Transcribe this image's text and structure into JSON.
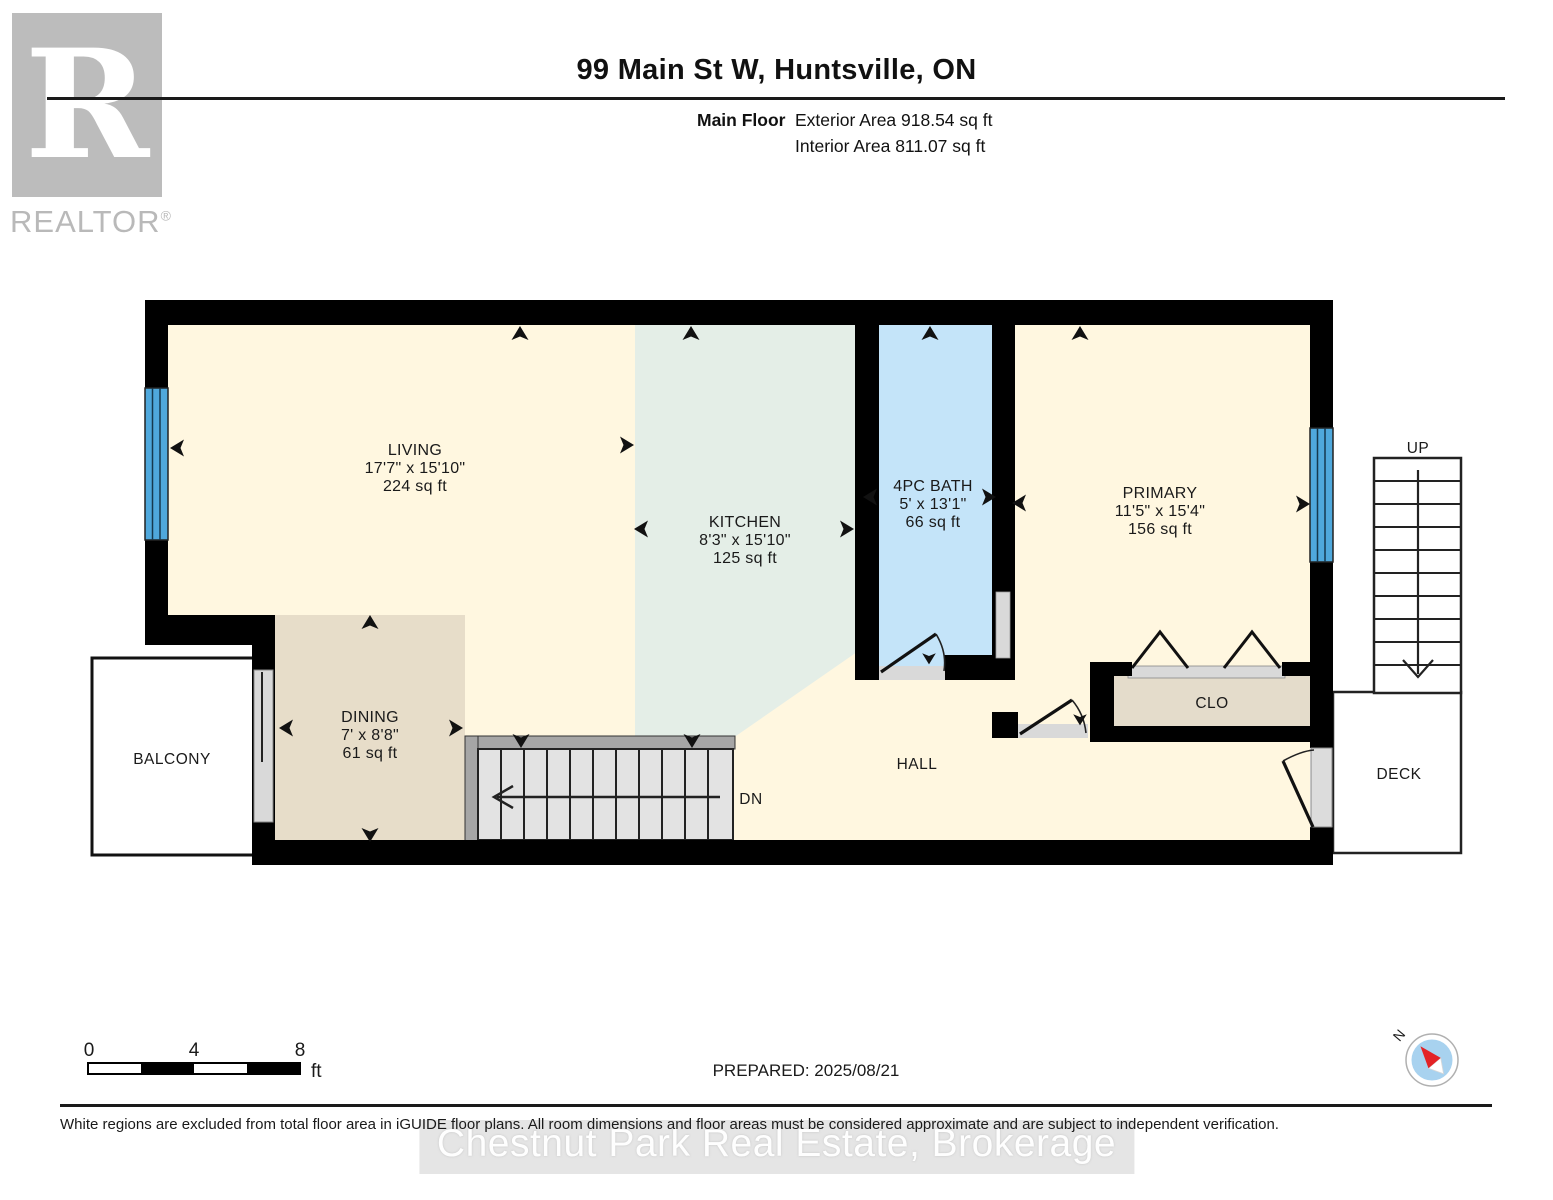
{
  "header": {
    "title": "99 Main St W, Huntsville, ON",
    "floor_label": "Main Floor",
    "exterior_area": "Exterior Area 918.54 sq ft",
    "interior_area": "Interior Area 811.07 sq ft",
    "brand_letter": "R",
    "brand_name": "REALTOR",
    "brand_reg": "®"
  },
  "rooms": {
    "living": {
      "name": "LIVING",
      "dims": "17'7\" x 15'10\"",
      "area": "224 sq ft"
    },
    "kitchen": {
      "name": "KITCHEN",
      "dims": "8'3\" x 15'10\"",
      "area": "125 sq ft"
    },
    "bath": {
      "name": "4PC BATH",
      "dims": "5' x 13'1\"",
      "area": "66 sq ft"
    },
    "primary": {
      "name": "PRIMARY",
      "dims": "11'5\" x 15'4\"",
      "area": "156 sq ft"
    },
    "dining": {
      "name": "DINING",
      "dims": "7' x 8'8\"",
      "area": "61 sq ft"
    }
  },
  "areas": {
    "balcony": "BALCONY",
    "hall": "HALL",
    "closet": "CLO",
    "deck": "DECK",
    "stairs_down": "DN",
    "stairs_up": "UP"
  },
  "scalebar": {
    "ticks": [
      "0",
      "4",
      "8"
    ],
    "unit": "ft"
  },
  "compass": {
    "north": "N"
  },
  "footer": {
    "prepared": "PREPARED: 2025/08/21",
    "disclaimer": "White regions are excluded from total floor area in iGUIDE floor plans. All room dimensions and floor areas must be considered approximate and are subject to independent verification.",
    "watermark": "Chestnut Park Real Estate, Brokerage"
  },
  "colors": {
    "wall": "#000000",
    "room_cream": "#FFF7E0",
    "kitchen_green": "#E4EEE7",
    "bath_blue": "#C4E4F9",
    "dining_tan": "#E7DDC9",
    "closet_tan": "#E4DCCB",
    "window_blue": "#4FA8DC",
    "stair_gray": "#E3E3E3",
    "rail_gray": "#A6A6A6",
    "door_gray": "#D9D9D9",
    "compass_blue": "#A8D2EF",
    "compass_red": "#E32226"
  }
}
